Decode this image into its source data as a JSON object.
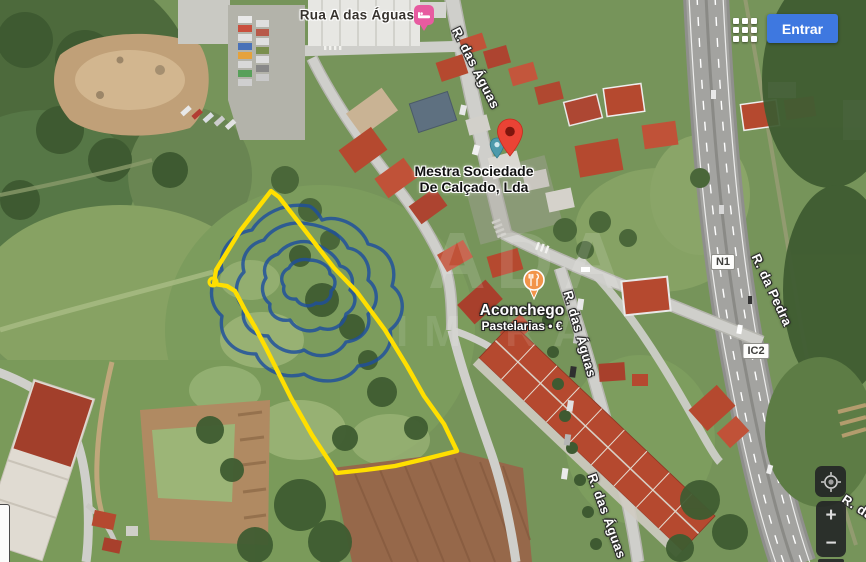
{
  "header": {
    "signin_label": "Entrar"
  },
  "streets": {
    "rua_a_das_aguas": "Rua A das Águas",
    "r_das_aguas": "R. das Águas",
    "r_da_pedra": "R. da Pedra"
  },
  "routes": {
    "n1": "N1",
    "ic2": "IC2"
  },
  "places": {
    "mestra_line1": "Mestra Sociedade",
    "mestra_line2": "De Calçado, Lda",
    "aconchego_name": "Aconchego",
    "aconchego_sub": "Pastelarias • €"
  },
  "controls": {
    "zoom_in": "+",
    "zoom_out": "−"
  },
  "watermark": {
    "line1": "ADA",
    "line2": "IM RA"
  },
  "icons": {
    "apps": "apps-grid-icon",
    "signin": "entrar-button",
    "my_location": "my-location-icon",
    "red_pin": "place-pin-icon",
    "food_pin": "restaurant-pin-icon",
    "lodging_pin": "lodging-pin-icon",
    "poi_teal": "poi-marker-icon"
  },
  "colors": {
    "accent_blue": "#3e78e0",
    "pin_red": "#ea4335",
    "poi_orange": "#f2944a",
    "lodging_pink": "#e75ba0",
    "parcel_yellow": "#ffdf00",
    "logo_blue": "#1e4f9e",
    "control_dark": "#212224"
  }
}
